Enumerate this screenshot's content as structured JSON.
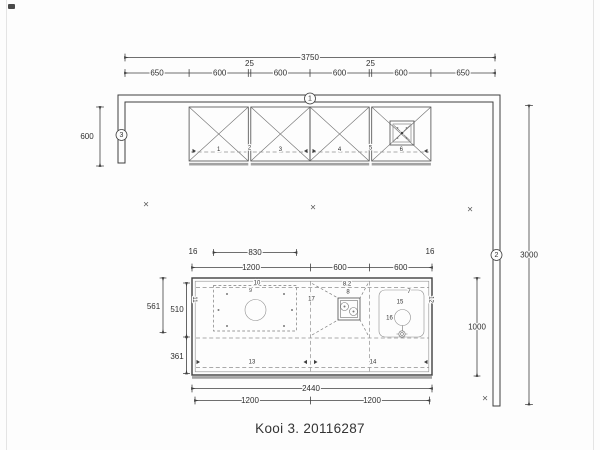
{
  "title": "Kooi 3. 20116287",
  "colors": {
    "line": "#3f3f3f",
    "dashed": "#8f8f8f",
    "thick_edge": "#a2a2a2",
    "text": "#2f2f2f",
    "background": "#fdfdfd"
  },
  "wall_markers": {
    "top": "1",
    "right": "2",
    "left": "3"
  },
  "dims": {
    "overall_width": "3750",
    "top_segments": [
      "650",
      "600",
      "600",
      "600",
      "600",
      "650"
    ],
    "top_gaps": [
      "25",
      "25"
    ],
    "left_return_depth": "600",
    "right_wall_length": "3000"
  },
  "island_dims": {
    "overhang_left": "16",
    "overhang_right": "16",
    "hob_width": "830",
    "top_segments": [
      "1200",
      "600",
      "600"
    ],
    "left_outer": "561",
    "left_upper": "510",
    "left_lower": "361",
    "depth": "1000",
    "overall_width": "2440",
    "bottom_segments": [
      "1200",
      "1200"
    ]
  },
  "cabinet_labels": [
    "1",
    "2",
    "3",
    "4",
    "5",
    "6"
  ],
  "island_labels": {
    "hob_zone": "10",
    "hob_detail": "9",
    "socket_ref": "8.2",
    "socket": "8",
    "sink_top": "7",
    "sink": "15",
    "tap": "16",
    "edge_left": "11",
    "edge_center": "17",
    "edge_right": "12",
    "bottom_left": "13",
    "bottom_right": "14"
  },
  "symbols": {
    "ceiling_mark": "×"
  }
}
